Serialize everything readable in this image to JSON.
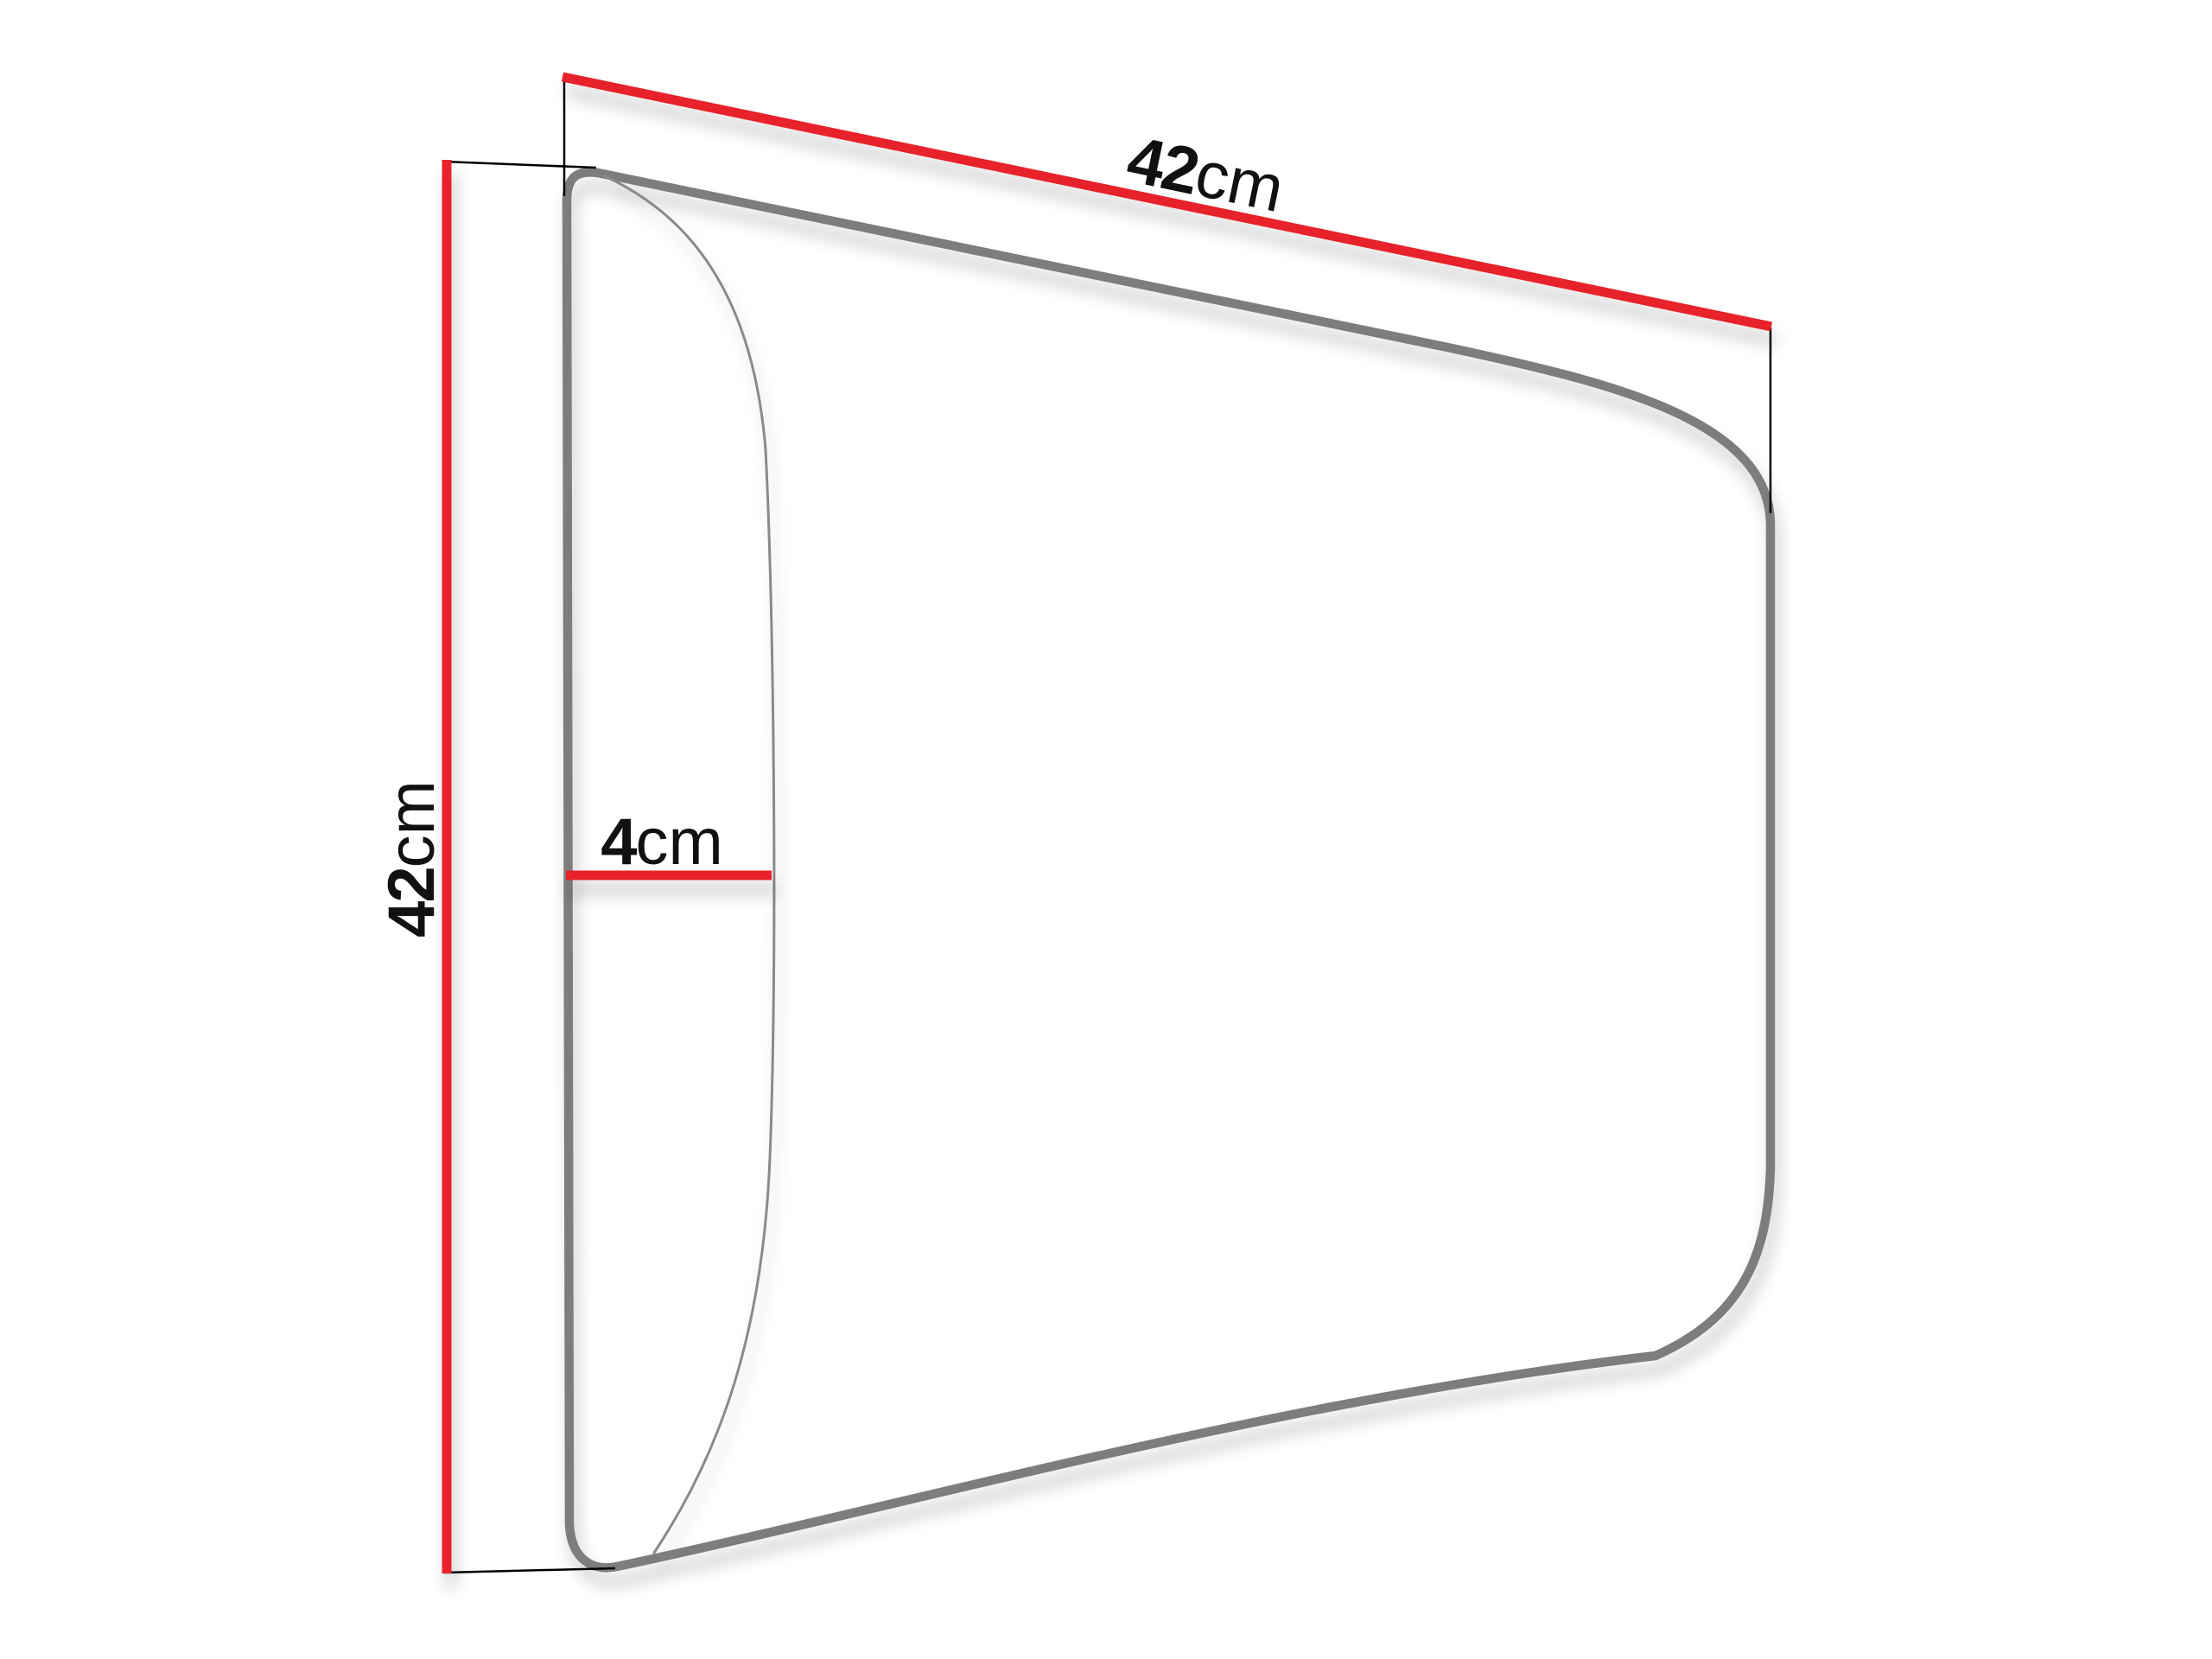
{
  "diagram": {
    "background_color": "#ffffff",
    "panel": {
      "face_color": "#ffffff",
      "outline_color": "#7d7d7d",
      "front_edge_color": "#8a8a8a"
    },
    "style": {
      "dimension_line_color": "#e8232b",
      "extension_line_color": "#000000",
      "label_color": "#111111"
    },
    "labels": {
      "width": {
        "value": "42",
        "unit": "cm"
      },
      "height": {
        "value": "42",
        "unit": "cm"
      },
      "depth": {
        "value": "4",
        "unit": "cm"
      }
    }
  }
}
